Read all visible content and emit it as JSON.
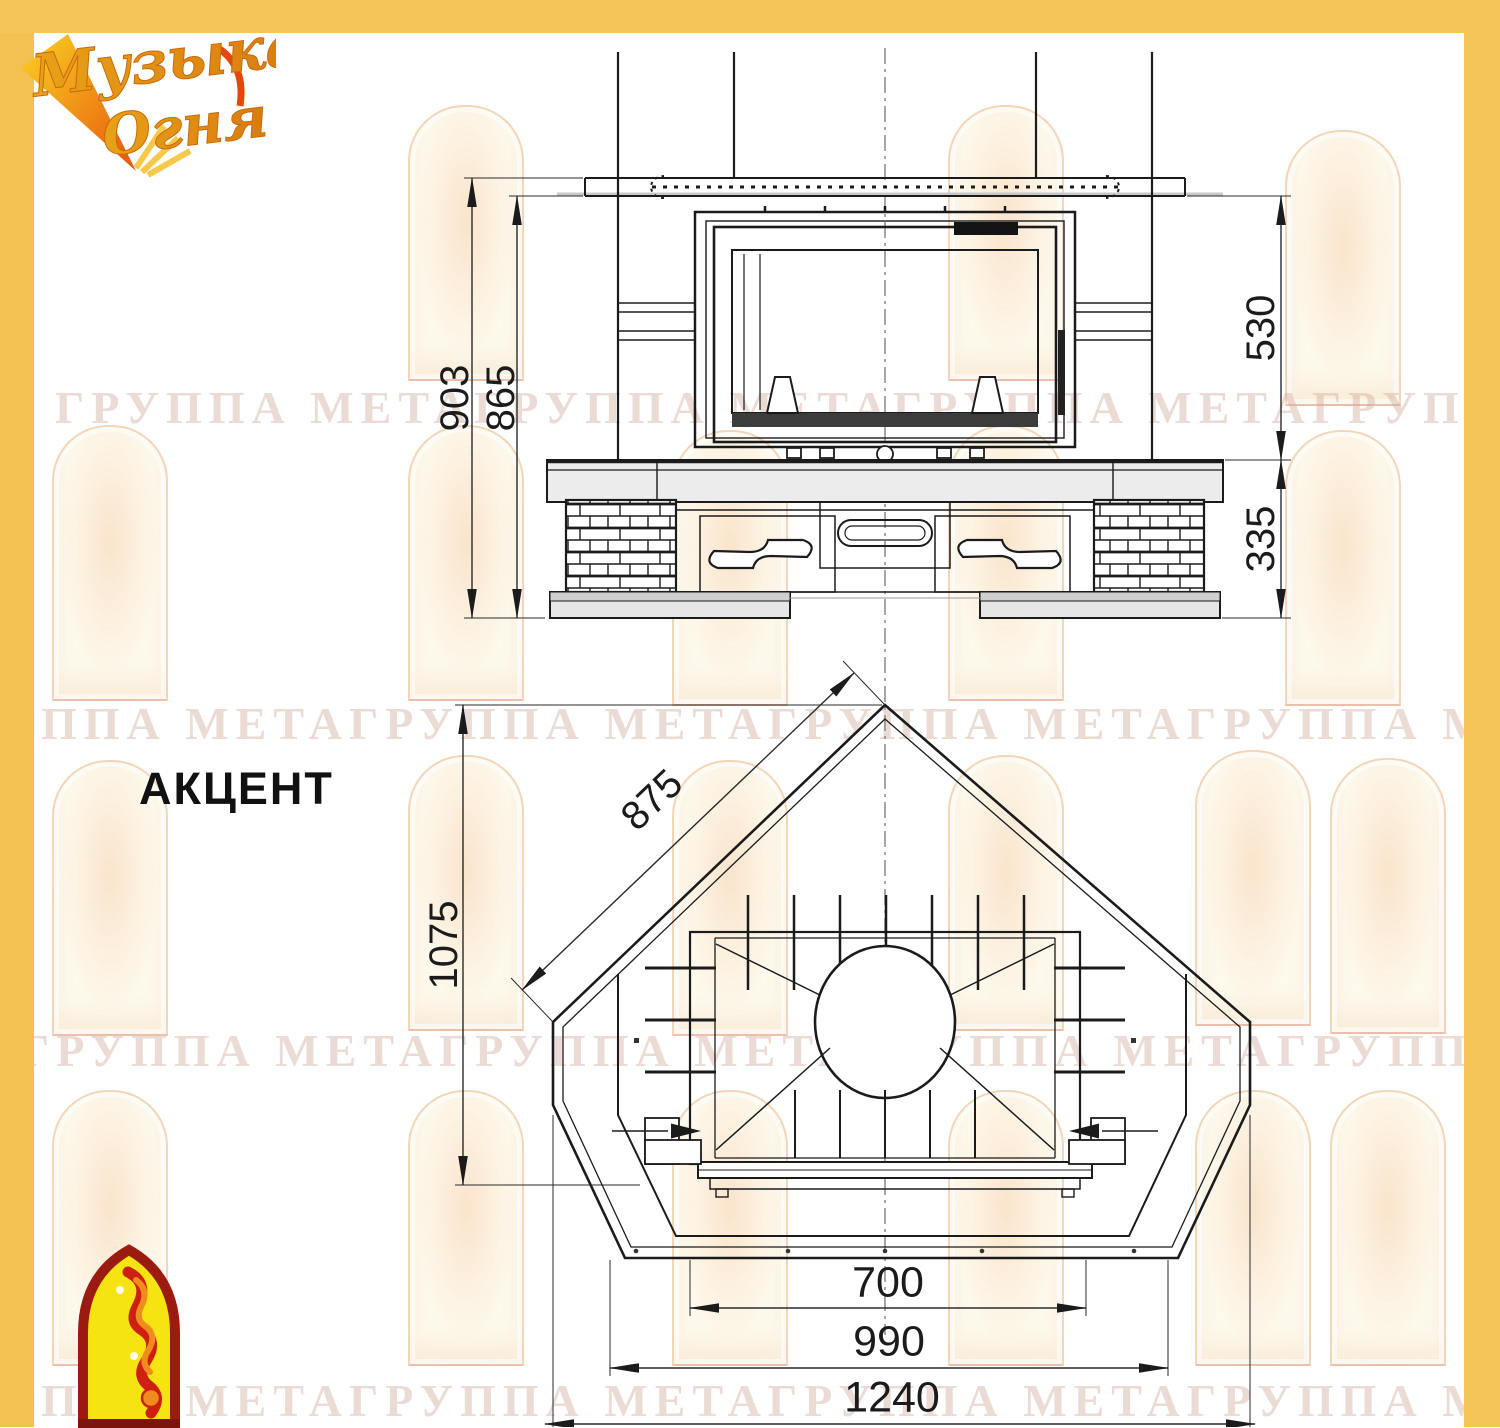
{
  "brand": {
    "line1": "Музыка",
    "line2": "Огня"
  },
  "model": {
    "name": "АКЦЕНТ"
  },
  "watermark": {
    "text": "ГРУППА МЕТАГРУППА МЕТАГРУППА МЕТАГРУППА МЕТА"
  },
  "dimensions": {
    "front": {
      "overall_height": "903",
      "inner_height": "865",
      "firebox_height": "530",
      "base_height": "335"
    },
    "plan": {
      "side": "875",
      "depth": "1075",
      "opening_width": "700",
      "mid_width": "990",
      "overall_width": "1240"
    }
  },
  "colors": {
    "frame": "#f6c55a",
    "line": "#1b1b1b",
    "watermark_text": "#eadcd3",
    "emblem_red": "#9b1b10",
    "emblem_yellow": "#f6e412"
  }
}
